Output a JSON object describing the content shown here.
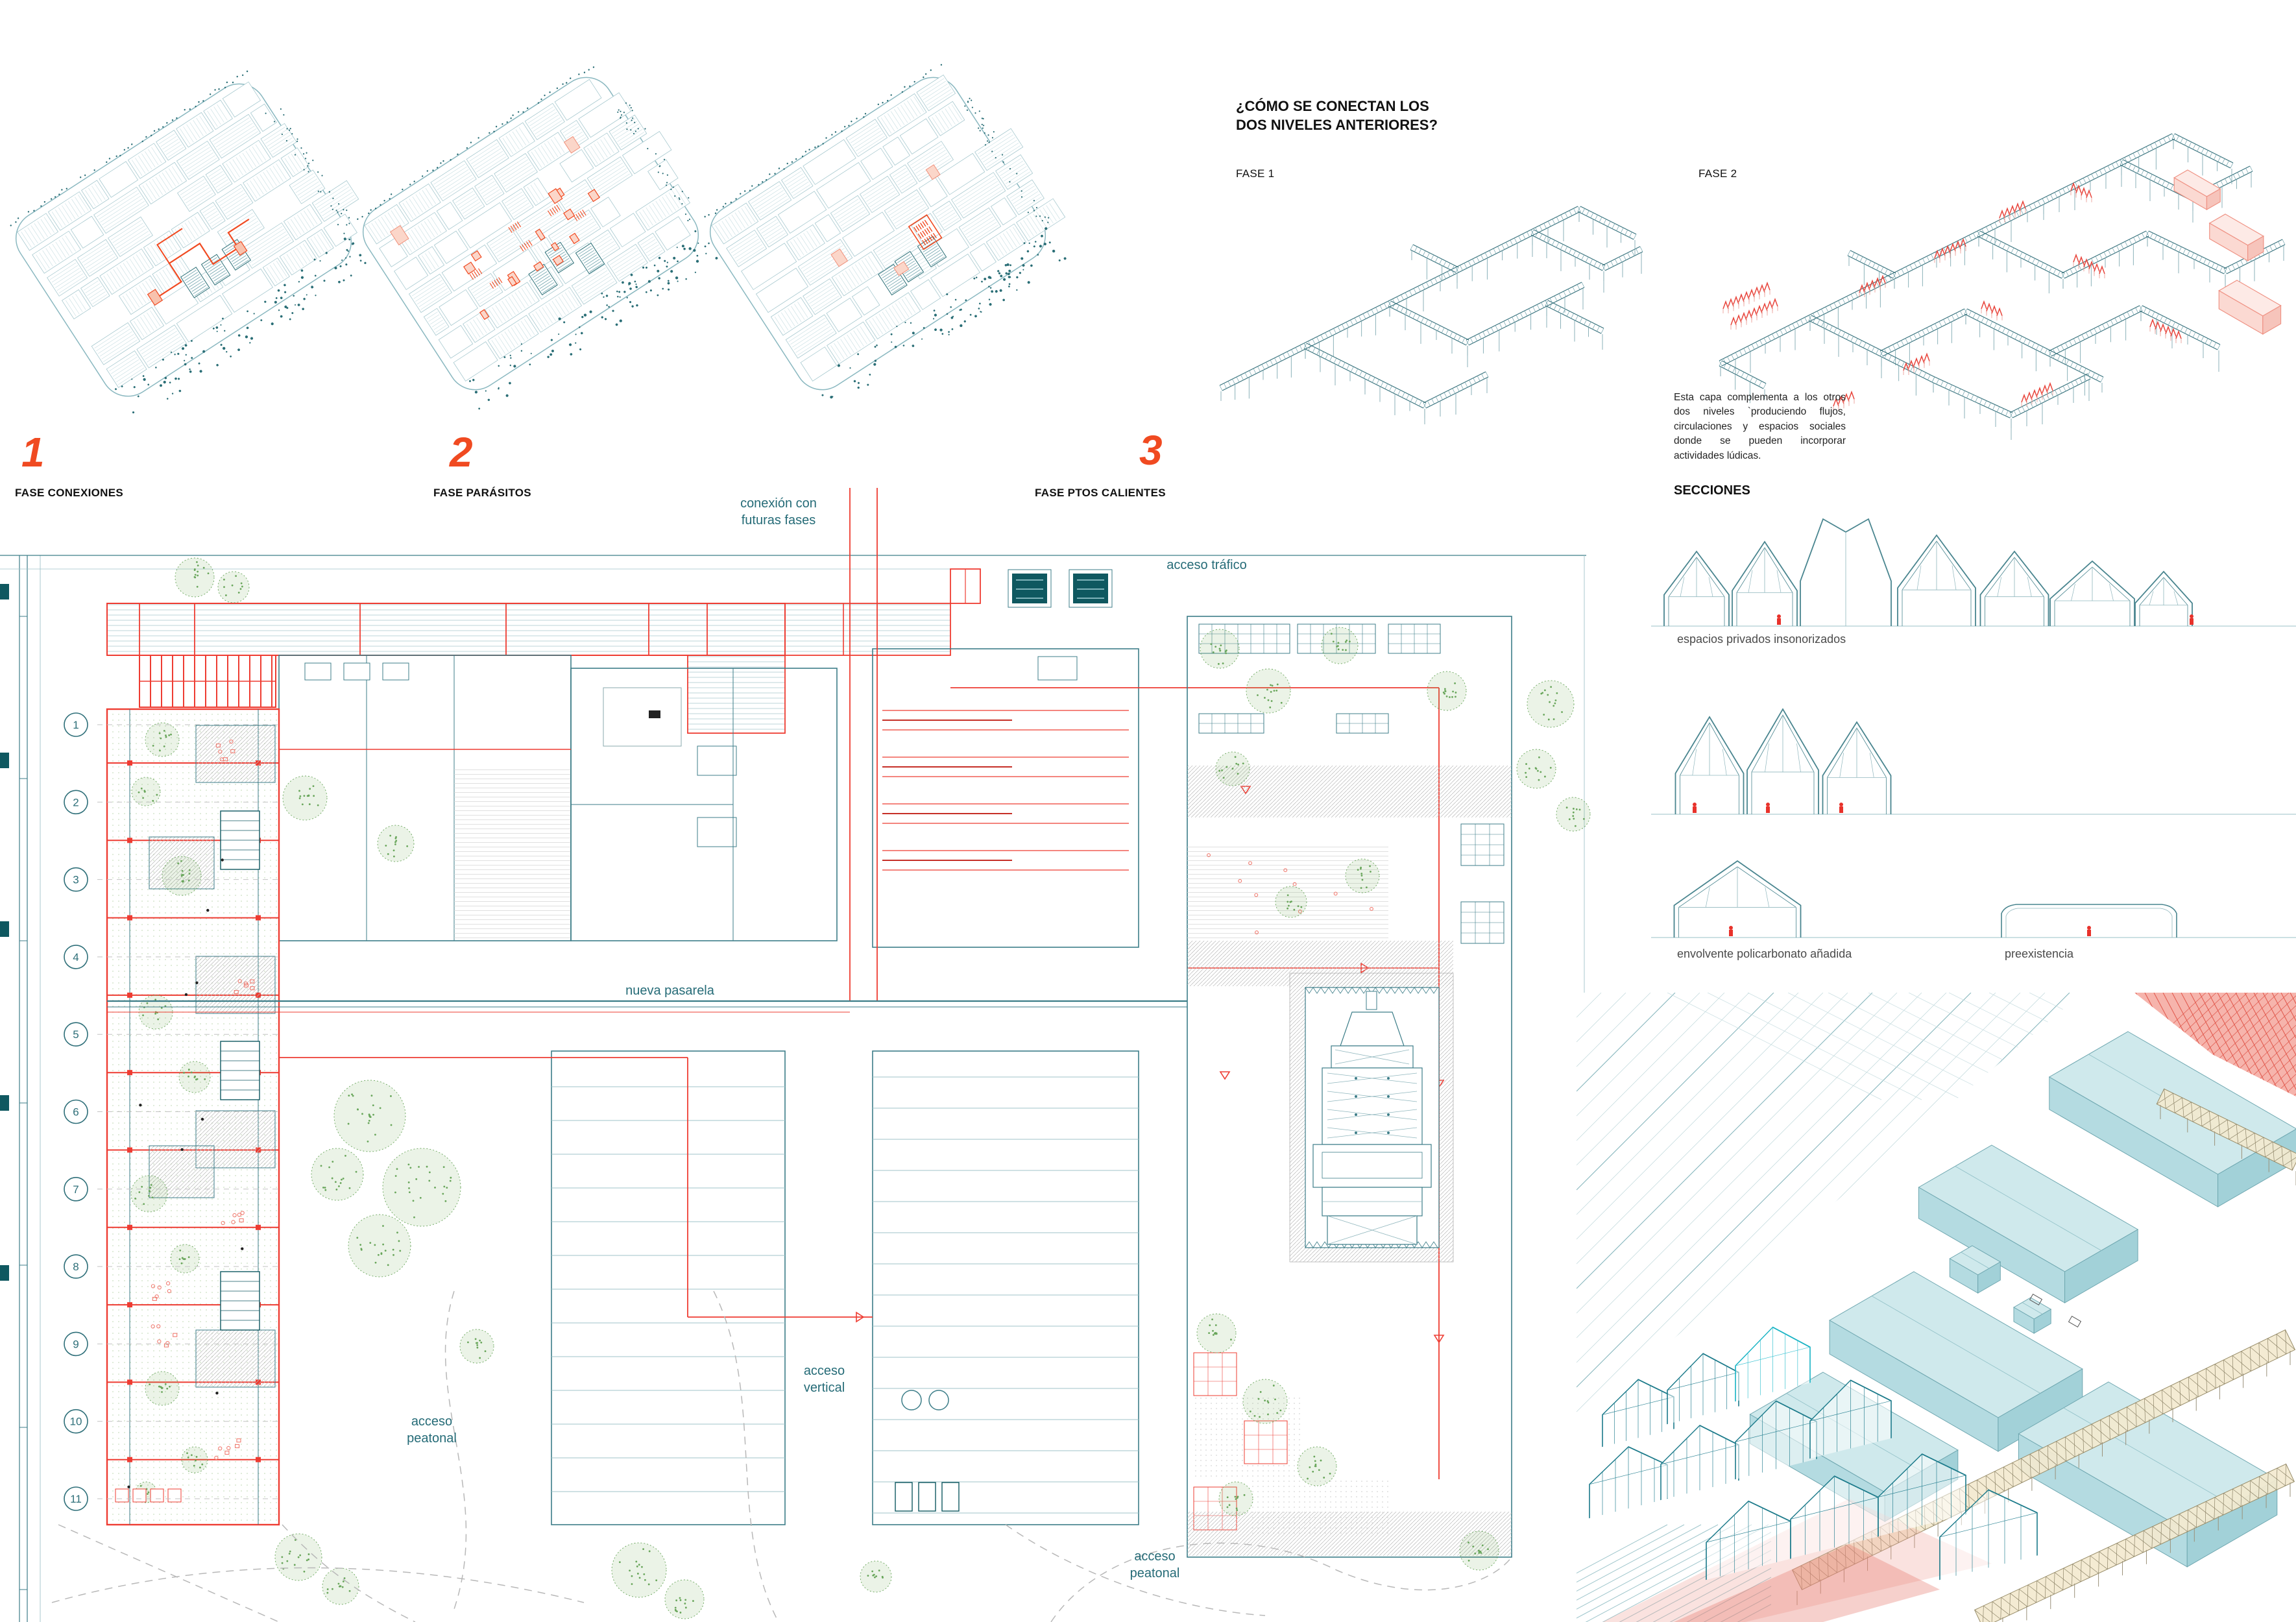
{
  "board": {
    "teal_line": "#3c7d88",
    "teal_light": "#9fc3ca",
    "teal_dark": "#0f5860",
    "teal_text": "#256b77",
    "orange": "#f04a21",
    "red": "#ee3c32",
    "green": "#69a65b",
    "gray_hatch": "#b8b8b8",
    "salmon": "#f5a79e",
    "tan": "#f3e9cf",
    "blue_volume": "#cde7ea"
  },
  "phases": [
    {
      "number": "1",
      "label": "FASE CONEXIONES"
    },
    {
      "number": "2",
      "label": "FASE PARÁSITOS"
    },
    {
      "number": "3",
      "label": "FASE PTOS CALIENTES"
    }
  ],
  "connection": {
    "title": "¿CÓMO SE CONECTAN LOS\nDOS NIVELES ANTERIORES?",
    "fase1_label": "FASE 1",
    "fase2_label": "FASE 2",
    "description": "Esta capa complementa a los otros dos niveles `produciendo flujos, circulaciones y espacios sociales donde se pueden incorporar actividades lúdicas."
  },
  "sections": {
    "title": "SECCIONES",
    "labels": {
      "insonorizados": "espacios privados insonorizados",
      "envolvente": "envolvente policarbonato añadida",
      "preexistencia": "preexistencia"
    }
  },
  "plan": {
    "labels": {
      "conexion": "conexión con\nfuturas fases",
      "trafico": "acceso tráfico",
      "pasarela": "nueva pasarela",
      "vertical": "acceso\nvertical",
      "peatonal_izq": "acceso\npeatonal",
      "peatonal_inf": "acceso\npeatonal"
    },
    "grid_numbers": [
      "1",
      "2",
      "3",
      "4",
      "5",
      "6",
      "7",
      "8",
      "9",
      "10",
      "11"
    ]
  }
}
